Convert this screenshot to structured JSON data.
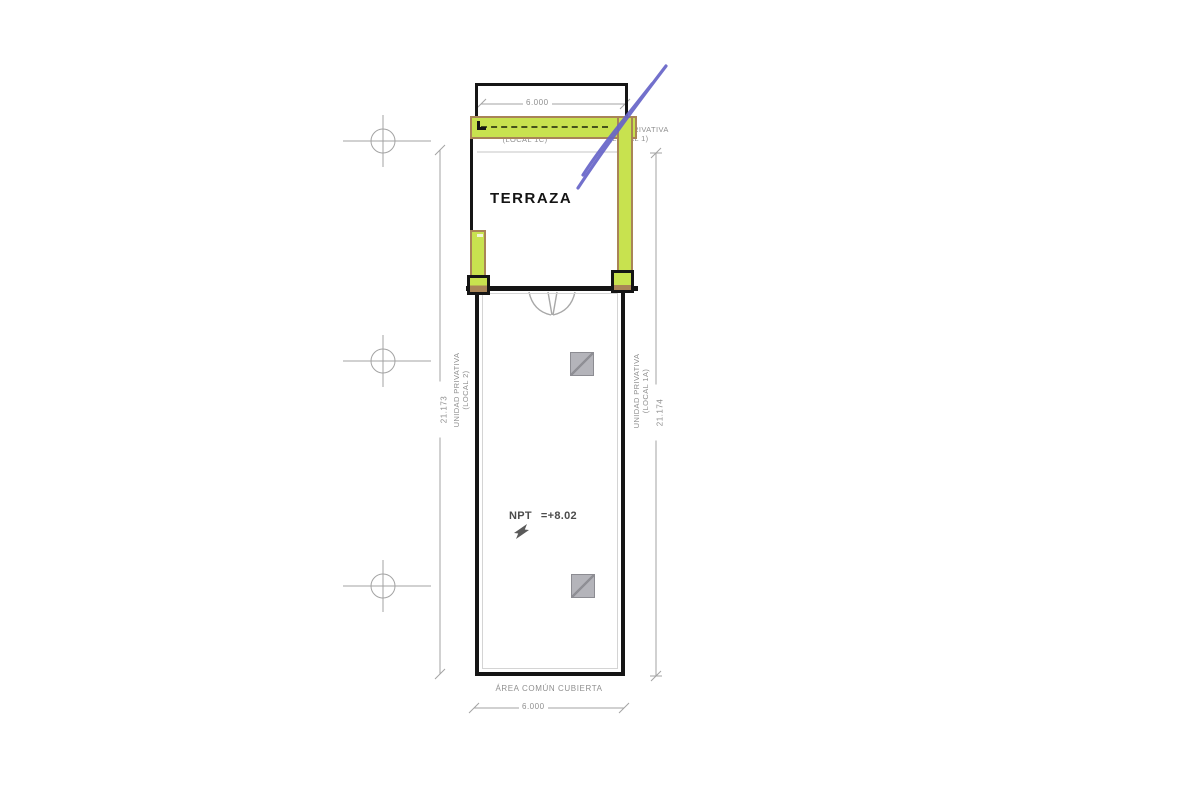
{
  "drawing": {
    "room_title": "TERRAZA",
    "npt_label": "NPT",
    "npt_value": "=+8.02",
    "area_label": "ÁREA COMÚN CUBIERTA",
    "local_1c_label": "(LOCAL 1C)",
    "top_dimension": "6.000",
    "bottom_dimension": "6.000",
    "left_dimension": "21.173",
    "right_dimension": "21.174",
    "unit_right_top": {
      "line1": "UNIDAD PRIVATIVA",
      "line2": "(LOCAL 1)"
    },
    "unit_left": {
      "line1": "UNIDAD PRIVATIVA",
      "line2": "(LOCAL 2)"
    },
    "unit_right": {
      "line1": "UNIDAD PRIVATIVA",
      "line2": "(LOCAL 1A)"
    },
    "colors": {
      "highlight_green": "#c8e24f",
      "highlight_tan": "#a98457",
      "pen_blue": "#6764c8",
      "wall_black": "#151515",
      "annotation_gray": "#8f8f8f"
    }
  }
}
